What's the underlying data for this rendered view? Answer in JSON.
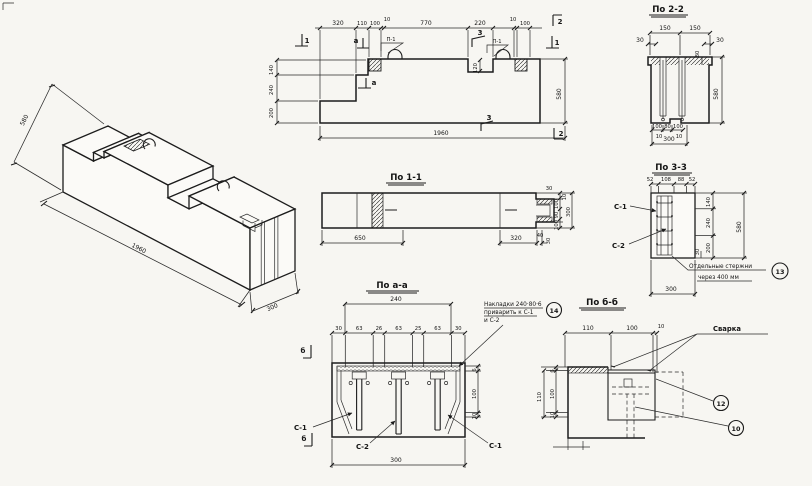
{
  "views": {
    "iso": {
      "dim_height": "580",
      "dim_length": "1960",
      "dim_width": "300"
    },
    "el": {
      "top_dims": [
        "320",
        "110",
        "100",
        "10",
        "770",
        "220",
        "10",
        "100"
      ],
      "left_dims": [
        "140",
        "240",
        "200"
      ],
      "right_dim": "580",
      "bottom_dim": "1960",
      "recess_dim": "120",
      "loop_label_1": "П-1",
      "loop_label_2": "П-1",
      "mark_1_left": "1",
      "mark_1_right": "1",
      "mark_2_top": "2",
      "mark_2_bottom": "2",
      "mark_3_top": "3",
      "mark_3_bottom": "3",
      "mark_a_top": "а",
      "mark_a_bottom": "а"
    },
    "s11": {
      "title": "По 1-1",
      "dim_650": "650",
      "dim_320": "320",
      "dim_40": "40",
      "dim_30_top": "30",
      "dim_30_bottom": "30",
      "right_dims": [
        "100",
        "90",
        "100"
      ],
      "dim_10": "10",
      "dim_300": "300"
    },
    "s22": {
      "title": "По 2-2",
      "top_dims": [
        "150",
        "150"
      ],
      "side_left": "30",
      "side_right": "30",
      "flange_dim": "80",
      "height_dim": "580",
      "bottom_dims": [
        "100",
        "80",
        "100"
      ],
      "bottom_small": [
        "10",
        "10"
      ],
      "bottom_total": "300"
    },
    "s33": {
      "title": "По 3-3",
      "top_dims": [
        "52",
        "108",
        "88",
        "52"
      ],
      "right_dims": [
        "140",
        "240",
        "200"
      ],
      "height_dim": "580",
      "offset_dim": "30",
      "bottom_dim": "300",
      "label_c1": "С-1",
      "label_c2": "С-2",
      "note_line1": "Отдельные стержни",
      "note_line2": "через 400 мм",
      "note_ref": "13"
    },
    "saa": {
      "title": "По а-а",
      "top_total": "240",
      "top_dims": [
        "30",
        "63",
        "26",
        "63",
        "25",
        "63",
        "30"
      ],
      "right_dims": [
        "6",
        "100",
        "10"
      ],
      "bottom_dim": "300",
      "label_c1_left": "С-1",
      "label_c2": "С-2",
      "label_c1_right": "С-1",
      "mark_b_top": "б",
      "mark_b_bottom": "б",
      "note_line1": "Накладки 240·80·6",
      "note_line2": "приварить к С-1",
      "note_line3": "и С-2",
      "note_ref": "14"
    },
    "sbb": {
      "title": "По б-б",
      "top_dims": [
        "110",
        "100",
        "10"
      ],
      "left_dims": [
        "6",
        "100",
        "10"
      ],
      "left_total": "110",
      "weld_label": "Сварка",
      "ref_12": "12",
      "ref_10": "10"
    }
  }
}
